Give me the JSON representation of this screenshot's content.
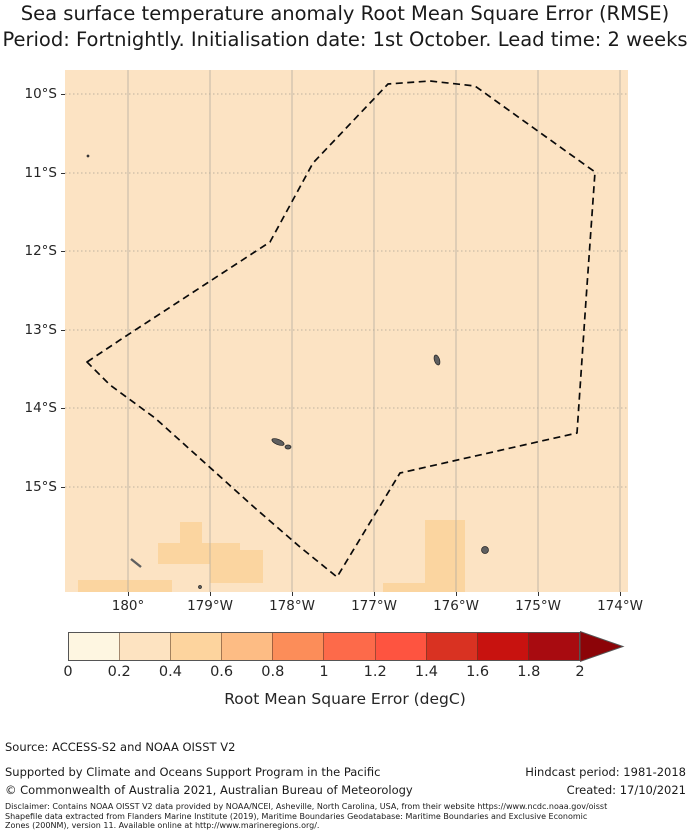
{
  "title": {
    "line1": "Sea surface temperature anomaly Root Mean Square Error (RMSE)",
    "line2": "Period: Fortnightly. Initialisation date: 1st October. Lead time: 2 weeks"
  },
  "map": {
    "background_color": "#fce3c3",
    "patch_color": "#fbd5a0",
    "island_color": "#5f5f5f",
    "gridline_color_vertical": "#b3aca0",
    "gridline_color_horizontal": "#a9a294",
    "x_tick_labels": [
      "180°",
      "179°W",
      "178°W",
      "177°W",
      "176°W",
      "175°W",
      "174°W"
    ],
    "y_tick_labels": [
      "10°S",
      "11°S",
      "12°S",
      "13°S",
      "14°S",
      "15°S"
    ],
    "x_tick_px": [
      63,
      145,
      227,
      309,
      391,
      473,
      555
    ],
    "y_tick_px": [
      24,
      103,
      181,
      260,
      338,
      417
    ],
    "boundary": {
      "style": "dashed",
      "color": "#0a0a0a",
      "points_px": [
        [
          22,
          292
        ],
        [
          58,
          268
        ],
        [
          205,
          172
        ],
        [
          248,
          93
        ],
        [
          323,
          14
        ],
        [
          365,
          11
        ],
        [
          410,
          16
        ],
        [
          530,
          102
        ],
        [
          521,
          230
        ],
        [
          512,
          363
        ],
        [
          335,
          403
        ],
        [
          272,
          507
        ],
        [
          235,
          477
        ],
        [
          190,
          438
        ],
        [
          140,
          393
        ],
        [
          90,
          348
        ],
        [
          45,
          315
        ]
      ]
    },
    "patches_px": [
      {
        "x": 115,
        "y": 452,
        "w": 22,
        "h": 21
      },
      {
        "x": 93,
        "y": 473,
        "w": 82,
        "h": 21
      },
      {
        "x": 145,
        "y": 480,
        "w": 53,
        "h": 33
      },
      {
        "x": 13,
        "y": 510,
        "w": 94,
        "h": 12
      },
      {
        "x": 360,
        "y": 450,
        "w": 40,
        "h": 72
      },
      {
        "x": 318,
        "y": 513,
        "w": 42,
        "h": 9
      }
    ],
    "islands_px": [
      {
        "shape": "ellipse",
        "cx": 372,
        "cy": 290,
        "rx": 2.6,
        "ry": 5.2,
        "rot": -18
      },
      {
        "shape": "ellipse",
        "cx": 213,
        "cy": 372,
        "rx": 6.5,
        "ry": 2.6,
        "rot": 22
      },
      {
        "shape": "ellipse",
        "cx": 223,
        "cy": 377,
        "rx": 3,
        "ry": 2,
        "rot": 0
      },
      {
        "shape": "circle",
        "cx": 420,
        "cy": 480,
        "r": 3.5
      },
      {
        "shape": "line",
        "x1": 66,
        "y1": 489,
        "x2": 76,
        "y2": 497
      },
      {
        "shape": "circle",
        "cx": 23,
        "cy": 86,
        "r": 1
      },
      {
        "shape": "circle",
        "cx": 135,
        "cy": 517,
        "r": 1.5
      }
    ]
  },
  "colorbar": {
    "tick_labels": [
      "0",
      "0.2",
      "0.4",
      "0.6",
      "0.8",
      "1",
      "1.2",
      "1.4",
      "1.6",
      "1.8",
      "2"
    ],
    "segment_colors": [
      "#fef6e1",
      "#fde3c1",
      "#fdd49e",
      "#fdbc84",
      "#fc8d59",
      "#fd6a4a",
      "#fe5440",
      "#d93222",
      "#c8120f",
      "#a80b10"
    ],
    "arrow_color": "#8c0408",
    "label": "Root Mean Square Error (degC)"
  },
  "footer": {
    "source": "Source: ACCESS-S2 and NOAA OISST V2",
    "supported": "Supported by Climate and Oceans Support Program in the Pacific",
    "copyright": "© Commonwealth of Australia 2021, Australian Bureau of Meteorology",
    "hindcast": "Hindcast period: 1981-2018",
    "created": "Created: 17/10/2021"
  },
  "disclaimer": {
    "line1": "Disclaimer: Contains NOAA OISST V2 data provided by NOAA/NCEI, Asheville, North Carolina, USA, from their website https://www.ncdc.noaa.gov/oisst",
    "line2": "Shapefile data extracted from Flanders Marine Institute (2019), Maritime Boundaries Geodatabase: Maritime Boundaries and Exclusive Economic",
    "line3": "Zones (200NM), version 11. Available online at http://www.marineregions.org/."
  },
  "chart_data": {
    "type": "heatmap",
    "title": "Sea surface temperature anomaly Root Mean Square Error (RMSE)",
    "subtitle": "Period: Fortnightly. Initialisation date: 1st October. Lead time: 2 weeks",
    "x": {
      "label": "",
      "ticks": [
        "180°",
        "179°W",
        "178°W",
        "177°W",
        "176°W",
        "175°W",
        "174°W"
      ]
    },
    "y": {
      "label": "",
      "ticks": [
        "10°S",
        "11°S",
        "12°S",
        "13°S",
        "14°S",
        "15°S"
      ]
    },
    "colorbar": {
      "label": "Root Mean Square Error (degC)",
      "ticks": [
        0,
        0.2,
        0.4,
        0.6,
        0.8,
        1,
        1.2,
        1.4,
        1.6,
        1.8,
        2
      ],
      "extend": "max",
      "n_segments": 10
    },
    "values": {
      "dominant_rmse_bin_degC": "0.2-0.4",
      "patch_rmse_bin_degC": "0.4-0.6",
      "patch_locations": "scattered grid cells near 15°S between roughly 179.5°W and 175.5°W"
    },
    "overlay": "dashed maritime boundary polygon enclosing region from about 9.9°S to 14.8°S",
    "grid": true,
    "legend_position": "bottom"
  }
}
